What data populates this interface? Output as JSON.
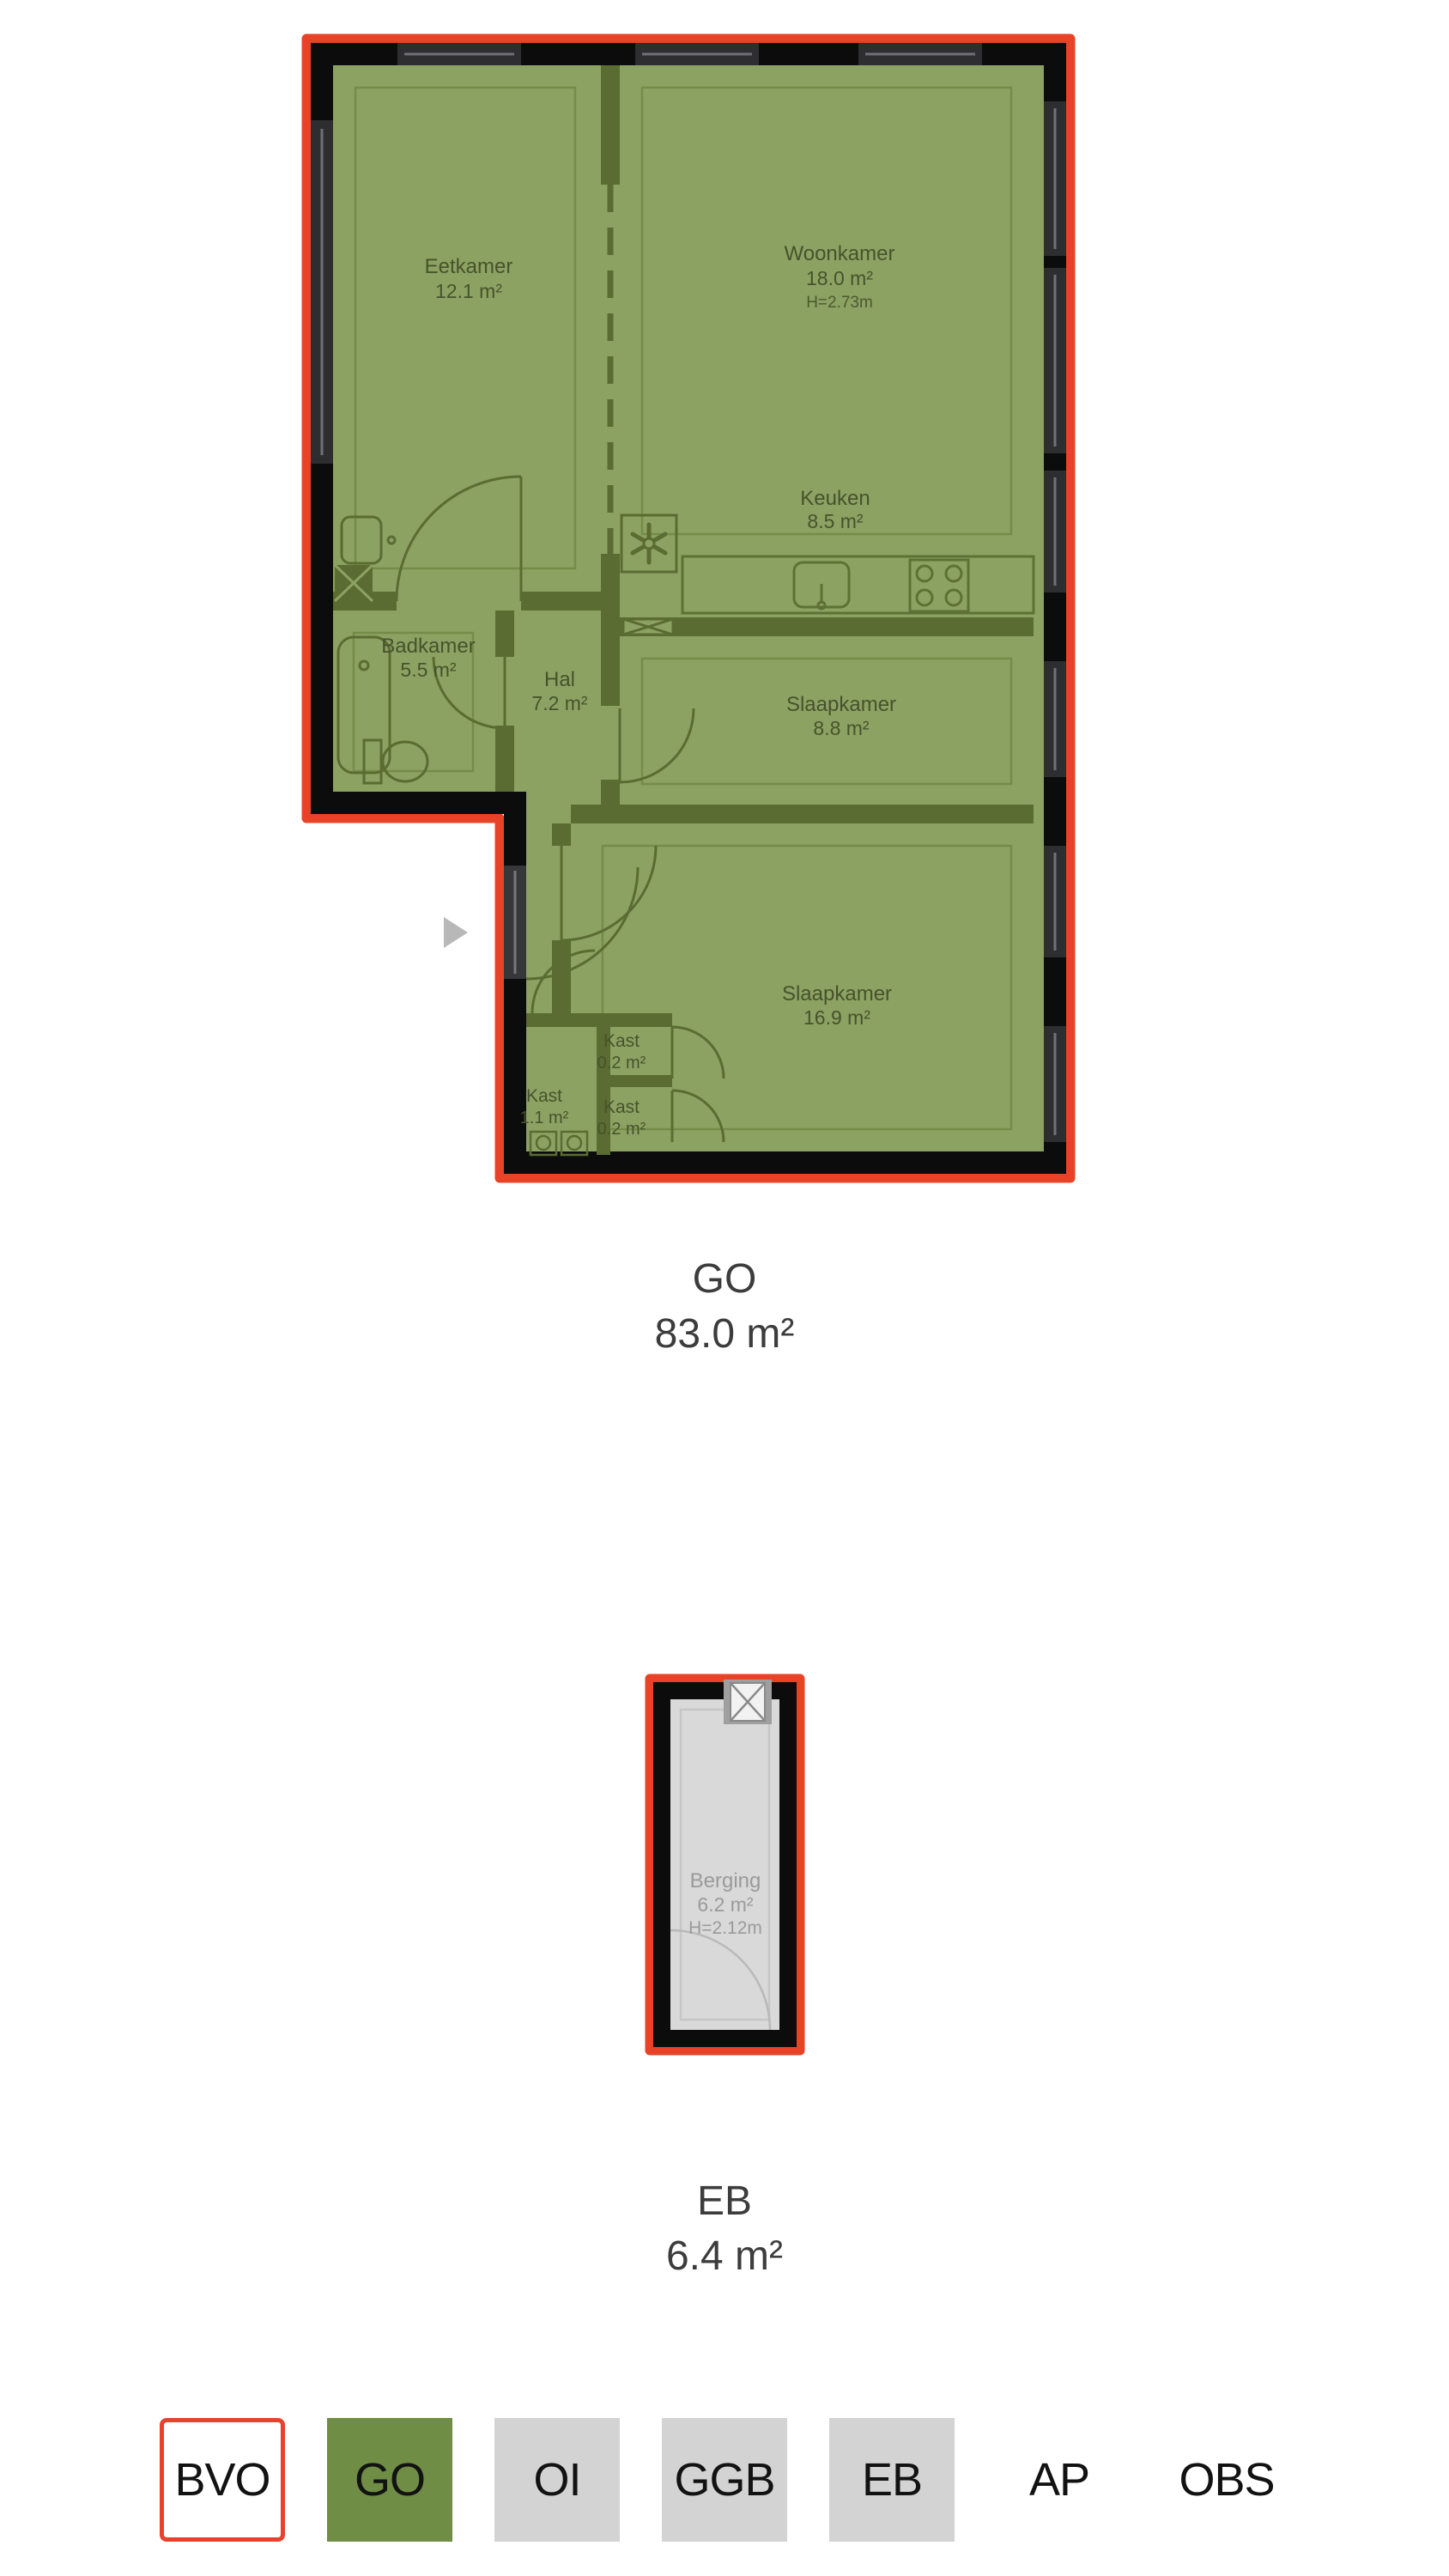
{
  "floorplans": [
    {
      "caption_code": "GO",
      "caption_area": "83.0 m²",
      "rooms": [
        {
          "name": "Eetkamer",
          "area": "12.1 m²"
        },
        {
          "name": "Woonkamer",
          "area": "18.0 m²",
          "height": "H=2.73m"
        },
        {
          "name": "Keuken",
          "area": "8.5 m²"
        },
        {
          "name": "Badkamer",
          "area": "5.5 m²"
        },
        {
          "name": "Hal",
          "area": "7.2 m²"
        },
        {
          "name": "Slaapkamer",
          "area": "8.8 m²"
        },
        {
          "name": "Slaapkamer",
          "area": "16.9 m²"
        },
        {
          "name": "Kast",
          "area": "1.1 m²"
        },
        {
          "name": "Kast",
          "area": "0.2 m²"
        },
        {
          "name": "Kast",
          "area": "0.2 m²"
        }
      ]
    },
    {
      "caption_code": "EB",
      "caption_area": "6.4 m²",
      "rooms": [
        {
          "name": "Berging",
          "area": "6.2 m²",
          "height": "H=2.12m"
        }
      ]
    }
  ],
  "carousel": {
    "next_icon": "play-arrow-icon"
  },
  "legend": {
    "items": [
      {
        "label": "BVO",
        "style": "outlined-red"
      },
      {
        "label": "GO",
        "style": "filled-green"
      },
      {
        "label": "OI",
        "style": "filled-gray"
      },
      {
        "label": "GGB",
        "style": "filled-gray"
      },
      {
        "label": "EB",
        "style": "filled-gray"
      },
      {
        "label": "AP",
        "style": "plain"
      },
      {
        "label": "OBS",
        "style": "plain"
      }
    ]
  },
  "colors": {
    "outline_red": "#e84327",
    "wall_black": "#0c0c0c",
    "plan_green": "#8ca263",
    "wall_green": "#5a6c31",
    "storage_gray": "#d9d9d9",
    "legend_green": "#6f8d44",
    "legend_gray": "#d3d3d3"
  }
}
